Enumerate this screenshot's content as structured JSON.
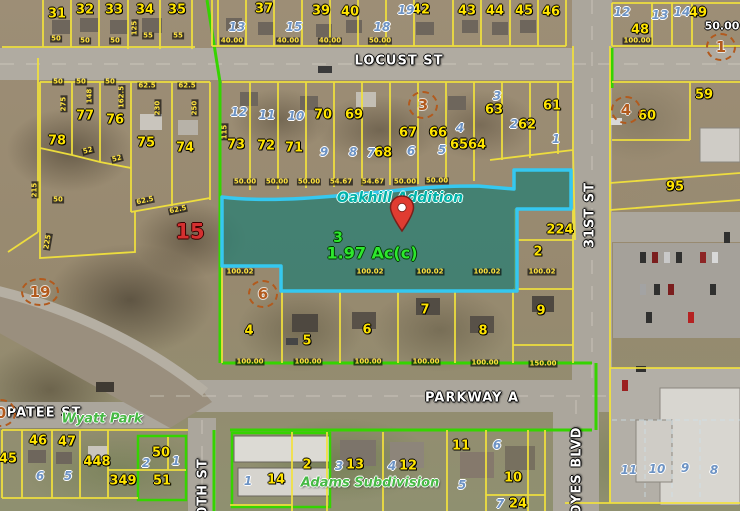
{
  "map": {
    "selected_parcel": {
      "subdivision": "Oakhill Addition",
      "lot": "3",
      "area": "1.97 Ac(c)"
    },
    "streets": [
      {
        "t": "LOCUST ST",
        "x": 399,
        "y": 61
      },
      {
        "t": "PARKWAY A",
        "x": 472,
        "y": 398
      },
      {
        "t": "PATEE ST",
        "x": 44,
        "y": 413
      },
      {
        "t": "31ST ST",
        "x": 590,
        "y": 215,
        "r": -90
      },
      {
        "t": "NOYES BLVD",
        "x": 577,
        "y": 477,
        "r": -90
      },
      {
        "t": "30TH ST",
        "x": 203,
        "y": 492,
        "r": -90
      }
    ],
    "place_labels": [
      {
        "t": "Wyatt Park",
        "x": 102,
        "y": 419
      },
      {
        "t": "Adams Subdivision",
        "x": 370,
        "y": 483
      }
    ],
    "block_circles": [
      {
        "t": "1",
        "x": 721,
        "y": 47
      },
      {
        "t": "3",
        "x": 423,
        "y": 105
      },
      {
        "t": "4",
        "x": 626,
        "y": 110
      },
      {
        "t": "6",
        "x": 263,
        "y": 294
      },
      {
        "t": "19",
        "x": 40,
        "y": 292,
        "wide": true
      },
      {
        "t": "0",
        "x": 1,
        "y": 413
      }
    ],
    "red_label": {
      "t": "15",
      "x": 190,
      "y": 232
    },
    "lot_labels": [
      {
        "t": "31",
        "x": 57,
        "y": 14
      },
      {
        "t": "32",
        "x": 85,
        "y": 10
      },
      {
        "t": "33",
        "x": 114,
        "y": 10
      },
      {
        "t": "34",
        "x": 145,
        "y": 10
      },
      {
        "t": "35",
        "x": 177,
        "y": 10
      },
      {
        "t": "37",
        "x": 264,
        "y": 9
      },
      {
        "t": "39",
        "x": 321,
        "y": 11
      },
      {
        "t": "40",
        "x": 350,
        "y": 12
      },
      {
        "t": "42",
        "x": 421,
        "y": 10
      },
      {
        "t": "43",
        "x": 467,
        "y": 11
      },
      {
        "t": "44",
        "x": 495,
        "y": 11
      },
      {
        "t": "45",
        "x": 524,
        "y": 11
      },
      {
        "t": "46",
        "x": 551,
        "y": 12
      },
      {
        "t": "48",
        "x": 640,
        "y": 30
      },
      {
        "t": "49",
        "x": 698,
        "y": 13
      },
      {
        "t": "59",
        "x": 704,
        "y": 95
      },
      {
        "t": "60",
        "x": 647,
        "y": 116
      },
      {
        "t": "61",
        "x": 552,
        "y": 106
      },
      {
        "t": "62",
        "x": 527,
        "y": 125
      },
      {
        "t": "63",
        "x": 494,
        "y": 110
      },
      {
        "t": "64",
        "x": 477,
        "y": 145
      },
      {
        "t": "65",
        "x": 459,
        "y": 145
      },
      {
        "t": "66",
        "x": 438,
        "y": 133
      },
      {
        "t": "67",
        "x": 408,
        "y": 133
      },
      {
        "t": "68",
        "x": 383,
        "y": 153
      },
      {
        "t": "69",
        "x": 354,
        "y": 115
      },
      {
        "t": "70",
        "x": 323,
        "y": 115
      },
      {
        "t": "71",
        "x": 294,
        "y": 148
      },
      {
        "t": "72",
        "x": 266,
        "y": 146
      },
      {
        "t": "73",
        "x": 236,
        "y": 145
      },
      {
        "t": "74",
        "x": 185,
        "y": 148
      },
      {
        "t": "75",
        "x": 146,
        "y": 143
      },
      {
        "t": "76",
        "x": 115,
        "y": 120
      },
      {
        "t": "77",
        "x": 85,
        "y": 116
      },
      {
        "t": "78",
        "x": 57,
        "y": 141
      },
      {
        "t": "95",
        "x": 675,
        "y": 187
      },
      {
        "t": "224",
        "x": 560,
        "y": 230
      },
      {
        "t": "2",
        "x": 538,
        "y": 252
      },
      {
        "t": "9",
        "x": 541,
        "y": 311
      },
      {
        "t": "8",
        "x": 483,
        "y": 331
      },
      {
        "t": "7",
        "x": 425,
        "y": 310
      },
      {
        "t": "6",
        "x": 367,
        "y": 330
      },
      {
        "t": "5",
        "x": 307,
        "y": 341
      },
      {
        "t": "4",
        "x": 249,
        "y": 331
      },
      {
        "t": "45",
        "x": 8,
        "y": 459
      },
      {
        "t": "46",
        "x": 38,
        "y": 441
      },
      {
        "t": "47",
        "x": 67,
        "y": 442
      },
      {
        "t": "448",
        "x": 97,
        "y": 462
      },
      {
        "t": "349",
        "x": 123,
        "y": 481
      },
      {
        "t": "50",
        "x": 161,
        "y": 453
      },
      {
        "t": "51",
        "x": 162,
        "y": 481
      },
      {
        "t": "14",
        "x": 276,
        "y": 480
      },
      {
        "t": "2",
        "x": 307,
        "y": 465
      },
      {
        "t": "13",
        "x": 355,
        "y": 465
      },
      {
        "t": "12",
        "x": 408,
        "y": 466
      },
      {
        "t": "11",
        "x": 461,
        "y": 446
      },
      {
        "t": "10",
        "x": 513,
        "y": 478
      },
      {
        "t": "24",
        "x": 518,
        "y": 504
      }
    ],
    "blue_labels": [
      {
        "t": "13",
        "x": 237,
        "y": 27
      },
      {
        "t": "15",
        "x": 294,
        "y": 27
      },
      {
        "t": "18",
        "x": 382,
        "y": 27
      },
      {
        "t": "19",
        "x": 406,
        "y": 10
      },
      {
        "t": "12",
        "x": 622,
        "y": 12
      },
      {
        "t": "13",
        "x": 660,
        "y": 15
      },
      {
        "t": "14",
        "x": 682,
        "y": 12
      },
      {
        "t": "12",
        "x": 239,
        "y": 112
      },
      {
        "t": "11",
        "x": 267,
        "y": 115
      },
      {
        "t": "10",
        "x": 296,
        "y": 116
      },
      {
        "t": "9",
        "x": 324,
        "y": 152
      },
      {
        "t": "8",
        "x": 353,
        "y": 152
      },
      {
        "t": "7",
        "x": 371,
        "y": 153
      },
      {
        "t": "6",
        "x": 411,
        "y": 151
      },
      {
        "t": "5",
        "x": 442,
        "y": 150
      },
      {
        "t": "4",
        "x": 460,
        "y": 128
      },
      {
        "t": "3",
        "x": 497,
        "y": 96
      },
      {
        "t": "2",
        "x": 514,
        "y": 124
      },
      {
        "t": "1",
        "x": 556,
        "y": 139
      },
      {
        "t": "6",
        "x": 40,
        "y": 476
      },
      {
        "t": "5",
        "x": 68,
        "y": 476
      },
      {
        "t": "2",
        "x": 146,
        "y": 463
      },
      {
        "t": "1",
        "x": 176,
        "y": 461
      },
      {
        "t": "1",
        "x": 248,
        "y": 481
      },
      {
        "t": "3",
        "x": 339,
        "y": 466
      },
      {
        "t": "4",
        "x": 392,
        "y": 466
      },
      {
        "t": "5",
        "x": 462,
        "y": 485
      },
      {
        "t": "6",
        "x": 497,
        "y": 445
      },
      {
        "t": "7",
        "x": 500,
        "y": 504
      },
      {
        "t": "11",
        "x": 629,
        "y": 470
      },
      {
        "t": "10",
        "x": 657,
        "y": 469
      },
      {
        "t": "9",
        "x": 685,
        "y": 468
      },
      {
        "t": "8",
        "x": 714,
        "y": 470
      }
    ],
    "dim_labels": [
      {
        "t": "50",
        "x": 56,
        "y": 39
      },
      {
        "t": "50",
        "x": 85,
        "y": 41
      },
      {
        "t": "50",
        "x": 115,
        "y": 41
      },
      {
        "t": "125",
        "x": 135,
        "y": 28,
        "r": -90
      },
      {
        "t": "55",
        "x": 148,
        "y": 36
      },
      {
        "t": "55",
        "x": 178,
        "y": 36
      },
      {
        "t": "40.00",
        "x": 232,
        "y": 41
      },
      {
        "t": "40.00",
        "x": 288,
        "y": 41
      },
      {
        "t": "40.00",
        "x": 330,
        "y": 41
      },
      {
        "t": "50.00",
        "x": 380,
        "y": 41
      },
      {
        "t": "100.00",
        "x": 637,
        "y": 41
      },
      {
        "t": "50",
        "x": 58,
        "y": 82
      },
      {
        "t": "50",
        "x": 81,
        "y": 82
      },
      {
        "t": "50",
        "x": 110,
        "y": 82
      },
      {
        "t": "62.5",
        "x": 147,
        "y": 86
      },
      {
        "t": "62.5",
        "x": 187,
        "y": 86
      },
      {
        "t": "275",
        "x": 64,
        "y": 104,
        "r": -90
      },
      {
        "t": "148",
        "x": 90,
        "y": 96,
        "r": -90
      },
      {
        "t": "162.5",
        "x": 122,
        "y": 97,
        "r": -90
      },
      {
        "t": "230",
        "x": 158,
        "y": 108,
        "r": -90
      },
      {
        "t": "250",
        "x": 195,
        "y": 108,
        "r": -90
      },
      {
        "t": "115",
        "x": 225,
        "y": 132,
        "r": -90
      },
      {
        "t": "52",
        "x": 88,
        "y": 151,
        "r": -15
      },
      {
        "t": "52",
        "x": 117,
        "y": 159,
        "r": -15
      },
      {
        "t": "50",
        "x": 58,
        "y": 200
      },
      {
        "t": "215",
        "x": 35,
        "y": 190,
        "r": -90
      },
      {
        "t": "225",
        "x": 48,
        "y": 242,
        "r": -80
      },
      {
        "t": "62.5",
        "x": 145,
        "y": 201,
        "r": -12
      },
      {
        "t": "62.5",
        "x": 178,
        "y": 210,
        "r": -12
      },
      {
        "t": "50.00",
        "x": 245,
        "y": 182
      },
      {
        "t": "50.00",
        "x": 277,
        "y": 182
      },
      {
        "t": "50.00",
        "x": 309,
        "y": 182
      },
      {
        "t": "54.67",
        "x": 341,
        "y": 182
      },
      {
        "t": "54.67",
        "x": 373,
        "y": 182
      },
      {
        "t": "50.00",
        "x": 405,
        "y": 182
      },
      {
        "t": "50.00",
        "x": 437,
        "y": 181
      },
      {
        "t": "100.02",
        "x": 240,
        "y": 272
      },
      {
        "t": "100.02",
        "x": 370,
        "y": 272
      },
      {
        "t": "100.02",
        "x": 430,
        "y": 272
      },
      {
        "t": "100.02",
        "x": 487,
        "y": 272
      },
      {
        "t": "100.02",
        "x": 542,
        "y": 272
      },
      {
        "t": "100.00",
        "x": 250,
        "y": 362
      },
      {
        "t": "100.00",
        "x": 308,
        "y": 362
      },
      {
        "t": "100.00",
        "x": 368,
        "y": 362
      },
      {
        "t": "100.00",
        "x": 426,
        "y": 362
      },
      {
        "t": "100.00",
        "x": 485,
        "y": 363
      },
      {
        "t": "150.00",
        "x": 543,
        "y": 364
      }
    ],
    "white_dims": [
      {
        "t": "50.00",
        "x": 722,
        "y": 26
      }
    ]
  },
  "colors": {
    "parcel_line": "#f2e23c",
    "boundary_green": "#35d400",
    "selection_stroke": "#35c8f0",
    "selection_fill": "rgba(35,160,150,0.45)",
    "lot_text": "#ffe400",
    "block_text": "#6d93c4",
    "street_text": "#ffffff",
    "circle_text": "#b25a1d",
    "subdivision_teal": "#00b2a9",
    "area_green": "#2de82d",
    "red_text": "#d43030"
  }
}
